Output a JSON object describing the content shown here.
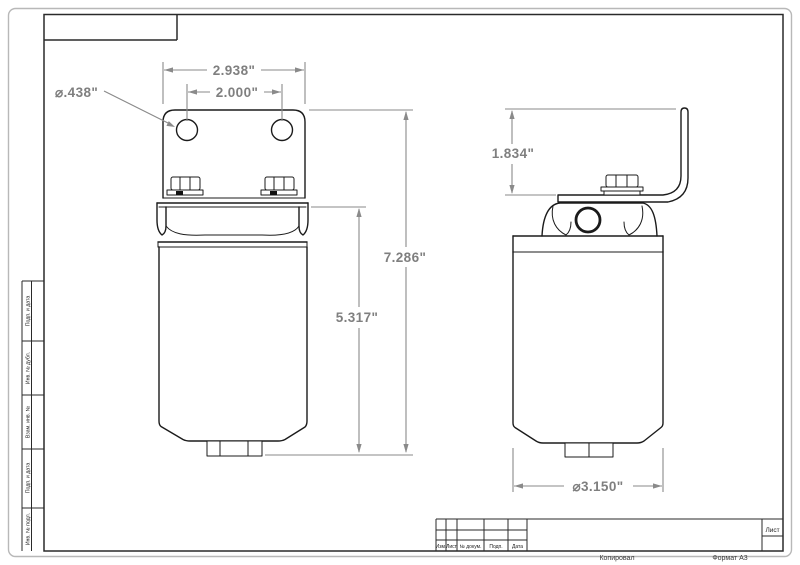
{
  "sheet": {
    "footer": {
      "copied": "Копировал",
      "format": "Формат А3"
    },
    "sidebar_labels": [
      "Подп. и дата",
      "Инв. № дубл.",
      "Взам. инв. №",
      "Подп. и дата",
      "Инв. № подл."
    ],
    "title_block": {
      "col_izm": "Изм.",
      "col_list": "Лист",
      "col_docnum": "№ докум.",
      "col_podp": "Подп.",
      "col_data": "Дата",
      "sheet_label": "Лист"
    }
  },
  "drawing": {
    "dimensions": {
      "bracket_width": "2.938\"",
      "hole_spacing": "2.000\"",
      "hole_diameter": "⌀.438\"",
      "overall_height": "7.286\"",
      "body_height": "5.317\"",
      "bracket_height": "1.834\"",
      "body_diameter": "⌀3.150\""
    },
    "colors": {
      "part_line": "#1b1b1b",
      "dimension_gray": "#8a8a8a"
    }
  }
}
